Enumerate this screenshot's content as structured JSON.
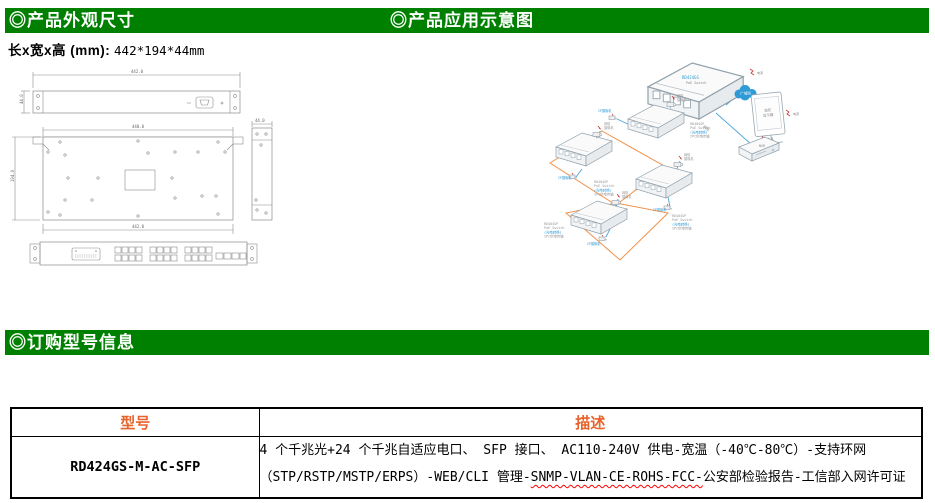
{
  "sections": {
    "dimensions_title": "◎产品外观尺寸",
    "application_title": "◎产品应用示意图",
    "ordering_title": "◎订购型号信息"
  },
  "dimensions": {
    "label": "长x宽x高 (mm):",
    "value": "442*194*44mm",
    "drawing": {
      "rear_w": "442.0",
      "rear_h": "44.0",
      "top_w": "440.0",
      "top_w2": "442.0",
      "top_d": "194.0",
      "side_w": "44.0"
    }
  },
  "diagram": {
    "cloud": "广域网",
    "monitor1": "监控",
    "monitor2": "显示器",
    "nvr": "NVR",
    "cable": "网线",
    "fiber": "光纤",
    "power": "电源",
    "core1": "RD424GS",
    "core2": "PoE Switch",
    "sw_l1": "RD404GP",
    "sw_l2": "PoE Switch",
    "sw_l3": "(光电转换)",
    "sw_l4": "IPC供电传输",
    "cam1": "网络",
    "cam2": "摄像机",
    "wallcam": "IP摄像机"
  },
  "ordering_table": {
    "headers": [
      "型号",
      "描述"
    ],
    "rows": [
      {
        "model": "RD424GS-M-AC-SFP",
        "desc_line1": "4 个千兆光+24 个千兆自适应电口、 SFP 接口、 AC110-240V 供电-宽温（-40℃-80℃）-支持环网",
        "desc_line2_pre": "（STP/RSTP/MSTP/ERPS）-WEB/CLI 管理-",
        "desc_line2_wavy": "SNMP-VLAN-CE-ROHS-FCC-",
        "desc_line2_post": "公安部检验报告-工信部入网许可证"
      }
    ]
  }
}
